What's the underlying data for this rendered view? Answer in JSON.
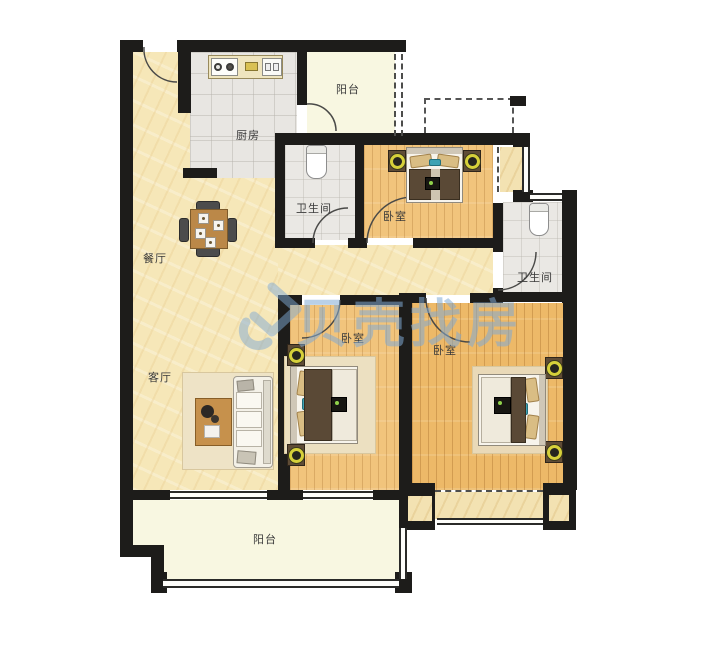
{
  "watermark": {
    "brand": "贝壳找房",
    "color": "#7fa9d4"
  },
  "rooms": {
    "balcony_top": {
      "label": "阳台"
    },
    "kitchen": {
      "label": "厨房"
    },
    "bathroom_1": {
      "label": "卫生间"
    },
    "bedroom_top": {
      "label": "卧室"
    },
    "bathroom_2": {
      "label": "卫生间"
    },
    "dining": {
      "label": "餐厅"
    },
    "living": {
      "label": "客厅"
    },
    "bedroom_middle": {
      "label": "卧室"
    },
    "bedroom_right": {
      "label": "卧室"
    },
    "balcony_bottom": {
      "label": "阳台"
    }
  },
  "colors": {
    "wall": "#1d1c1a",
    "watermark_blue": "#7fa9d4",
    "floor_cream": "#f6e7b8",
    "floor_tile": "#e8e6e2",
    "floor_wood": "#f1c47c",
    "floor_wood_dark": "#edb968",
    "balcony": "#f8f7e1",
    "bay_window": "#f3e2b2"
  }
}
